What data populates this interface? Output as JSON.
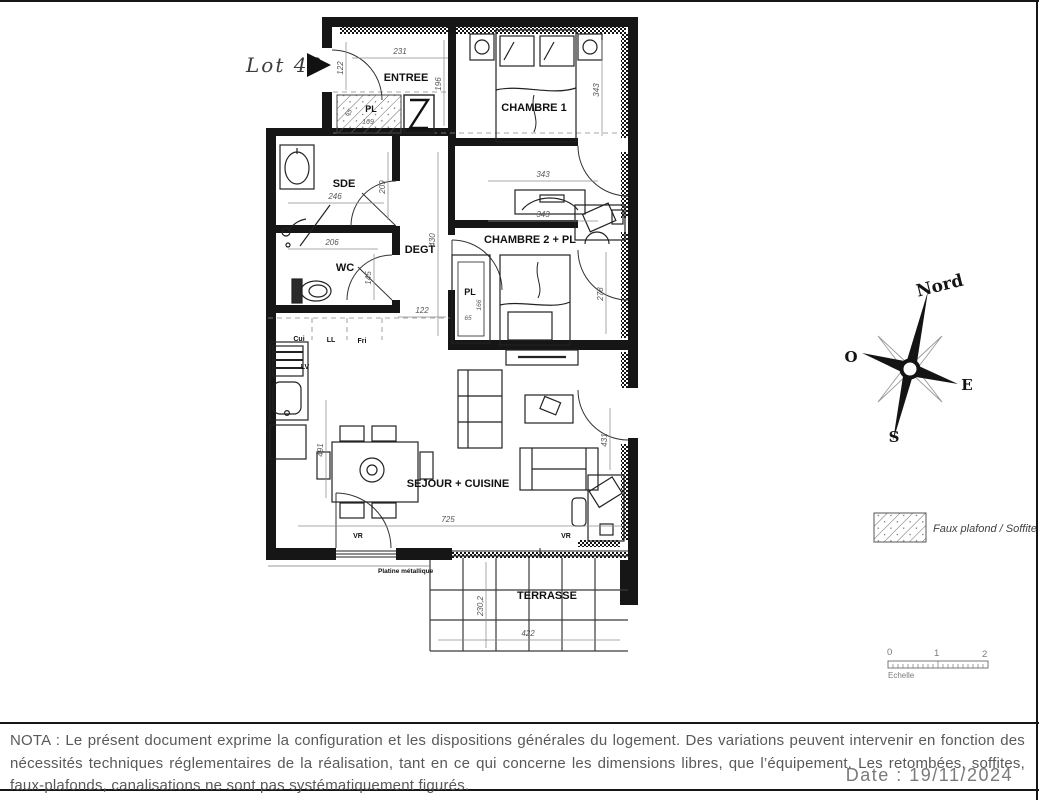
{
  "lot": {
    "label": "Lot 43"
  },
  "rooms": {
    "entree": "ENTREE",
    "sde": "SDE",
    "wc": "WC",
    "degt": "DEGT",
    "ch1": "CHAMBRE 1",
    "ch2": "CHAMBRE 2 + PL",
    "sejour": "SEJOUR + CUISINE",
    "terrasse": "TERRASSE",
    "pl1": "PL",
    "pl2": "PL"
  },
  "dims": {
    "d231": "231",
    "d122a": "122",
    "d196": "196",
    "d343a": "343",
    "d209": "209",
    "d246": "246",
    "d206": "206",
    "d145": "145",
    "d430": "430",
    "d122b": "122",
    "d343b": "343",
    "d343c": "343",
    "d278": "278",
    "d169": "169",
    "d65a": "65",
    "d166": "166",
    "d65b": "65",
    "d491": "491",
    "d725": "725",
    "d431": "431",
    "d2302": "230,2",
    "d422": "422"
  },
  "appliances": {
    "cui": "Cui",
    "ll": "LL",
    "fri": "Fri",
    "lv": "LV"
  },
  "labels": {
    "vr1": "VR",
    "vr2": "VR",
    "metal": "Platine métallique"
  },
  "compass": {
    "n": "Nord",
    "o": "O",
    "e": "E",
    "s": "S"
  },
  "legend": {
    "faux_plafond": "Faux plafond / Soffite"
  },
  "scalebar": {
    "t0": "0",
    "t1": "1",
    "t2": "2",
    "caption": "Echelle"
  },
  "nota": "NOTA : Le présent document exprime la configuration et les dispositions générales du logement. Des variations peuvent intervenir en fonction des nécessités techniques réglementaires de la réalisation, tant en ce qui concerne les dimensions libres, que l’équipement. Les retombées, soffites, faux-plafonds, canalisations ne sont pas systématiquement figurés.",
  "date": "Date : 19/11/2024"
}
